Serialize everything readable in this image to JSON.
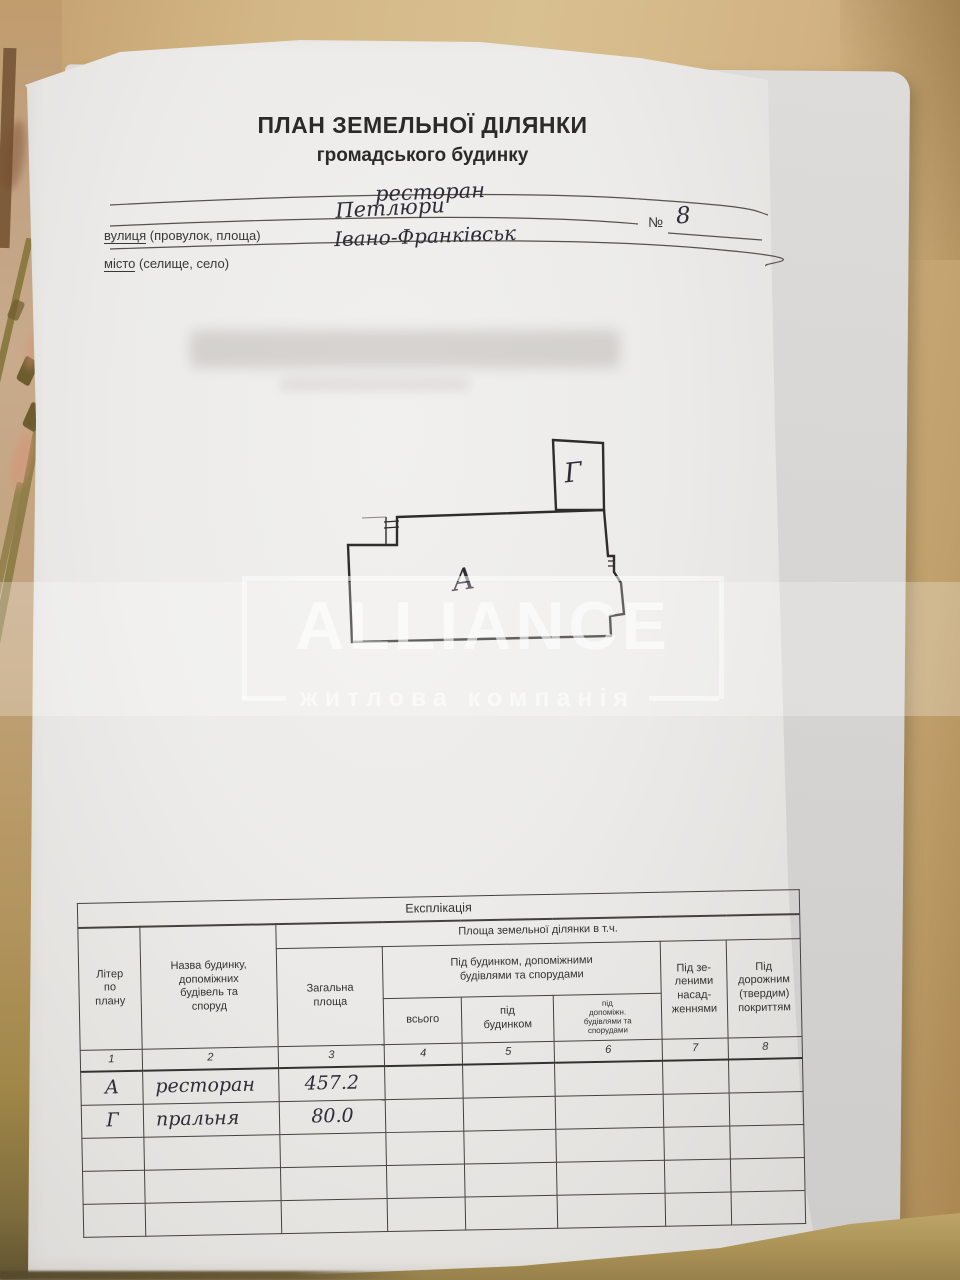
{
  "colors": {
    "paper": "#ecebe9",
    "print_ink": "#2c2a28",
    "hand_ink": "#2e2c38",
    "table_line": "#45423e",
    "watermark_white": "rgba(255,255,255,0.6)",
    "surface_tan": "#d3b685"
  },
  "header": {
    "title": "ПЛАН ЗЕМЕЛЬНОЇ ДІЛЯНКИ",
    "subtitle": "громадського будинку",
    "building_type_value": "ресторан",
    "street_label_word": "вулиця",
    "street_label_rest": " (провулок, площа)",
    "street_value": "Петлюри",
    "number_label": "№",
    "number_value": "8",
    "city_label_word": "місто",
    "city_label_rest": " (селище, село)",
    "city_value": "Івано-Франківськ"
  },
  "plan": {
    "building_a_label": "А",
    "building_g_label": "Г"
  },
  "watermark": {
    "name": "ALLIANCE",
    "tagline": "житлова компанія"
  },
  "table": {
    "title": "Експлікація",
    "area_group_header": "Площа земельної ділянки в т.ч.",
    "col_letter": "Літер\nпо\nплану",
    "col_name": "Назва будинку,\nдопоміжних\nбудівель та\nспоруд",
    "col_total": "Загальна\nплоща",
    "col_under_group": "Під будинком, допоміжними\nбудівлями та спорудами",
    "col_all": "всього",
    "col_under_building": "під\nбудинком",
    "col_under_aux": "під\nдопоміжн.\nбудівлями та\nспорудами",
    "col_green": "Під зе-\nленими\nнасад-\nженнями",
    "col_road": "Під\nдорожним\n(твердим)\nпокриттям",
    "col_numbers": [
      "1",
      "2",
      "3",
      "4",
      "5",
      "6",
      "7",
      "8"
    ],
    "rows": [
      {
        "letter": "А",
        "name": "ресторан",
        "total": "457.2",
        "c4": "",
        "c5": "",
        "c6": "",
        "c7": "",
        "c8": ""
      },
      {
        "letter": "Г",
        "name": "пральня",
        "total": "80.0",
        "c4": "",
        "c5": "",
        "c6": "",
        "c7": "",
        "c8": ""
      },
      {
        "letter": "",
        "name": "",
        "total": "",
        "c4": "",
        "c5": "",
        "c6": "",
        "c7": "",
        "c8": ""
      },
      {
        "letter": "",
        "name": "",
        "total": "",
        "c4": "",
        "c5": "",
        "c6": "",
        "c7": "",
        "c8": ""
      },
      {
        "letter": "",
        "name": "",
        "total": "",
        "c4": "",
        "c5": "",
        "c6": "",
        "c7": "",
        "c8": ""
      }
    ]
  }
}
